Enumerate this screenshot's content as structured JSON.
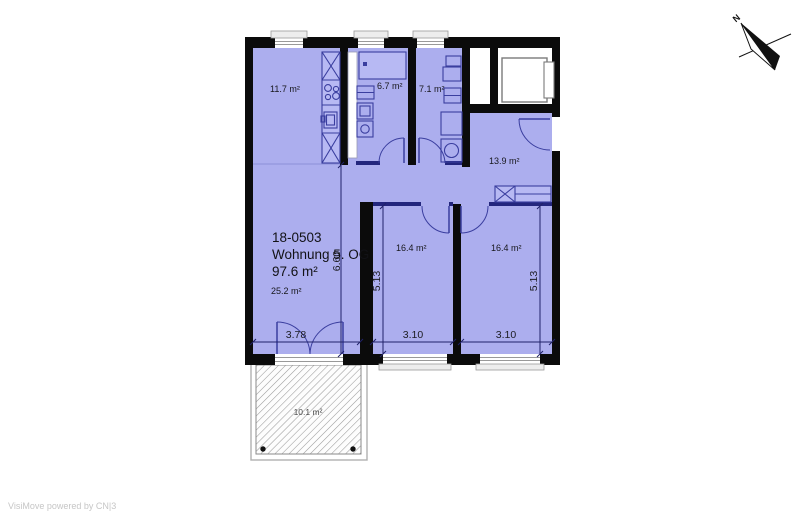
{
  "watermark": "VisiMove powered by CN|3",
  "compass": {
    "north_label": "N"
  },
  "unit": {
    "id": "18-0503",
    "name": "Wohnung 5. OG",
    "total_area": "97.6 m²"
  },
  "rooms": [
    {
      "name": "kitchen",
      "area": "11.7 m²"
    },
    {
      "name": "bathroom-small",
      "area": "6.7 m²"
    },
    {
      "name": "bathroom-large",
      "area": "7.1 m²"
    },
    {
      "name": "hallway",
      "area": "13.9 m²"
    },
    {
      "name": "bedroom-left",
      "area": "16.4 m²"
    },
    {
      "name": "bedroom-right",
      "area": "16.4 m²"
    },
    {
      "name": "living-room",
      "area": "25.2 m²"
    },
    {
      "name": "balcony",
      "area": "10.1 m²"
    }
  ],
  "dimensions": {
    "living_width": "3.78",
    "bedroom_left_width": "3.10",
    "bedroom_right_width": "3.10",
    "bedroom_left_depth": "5.13",
    "bedroom_right_depth": "5.13",
    "living_depth": "6.60"
  },
  "colors": {
    "room_fill": "#acaeee",
    "fixture_fill": "#b7b9f3",
    "wall": "#0b0b0b",
    "fixture_line": "#3a3e9f",
    "partition": "#23267d",
    "background": "#ffffff",
    "hatch_line": "#9b9b9b"
  }
}
